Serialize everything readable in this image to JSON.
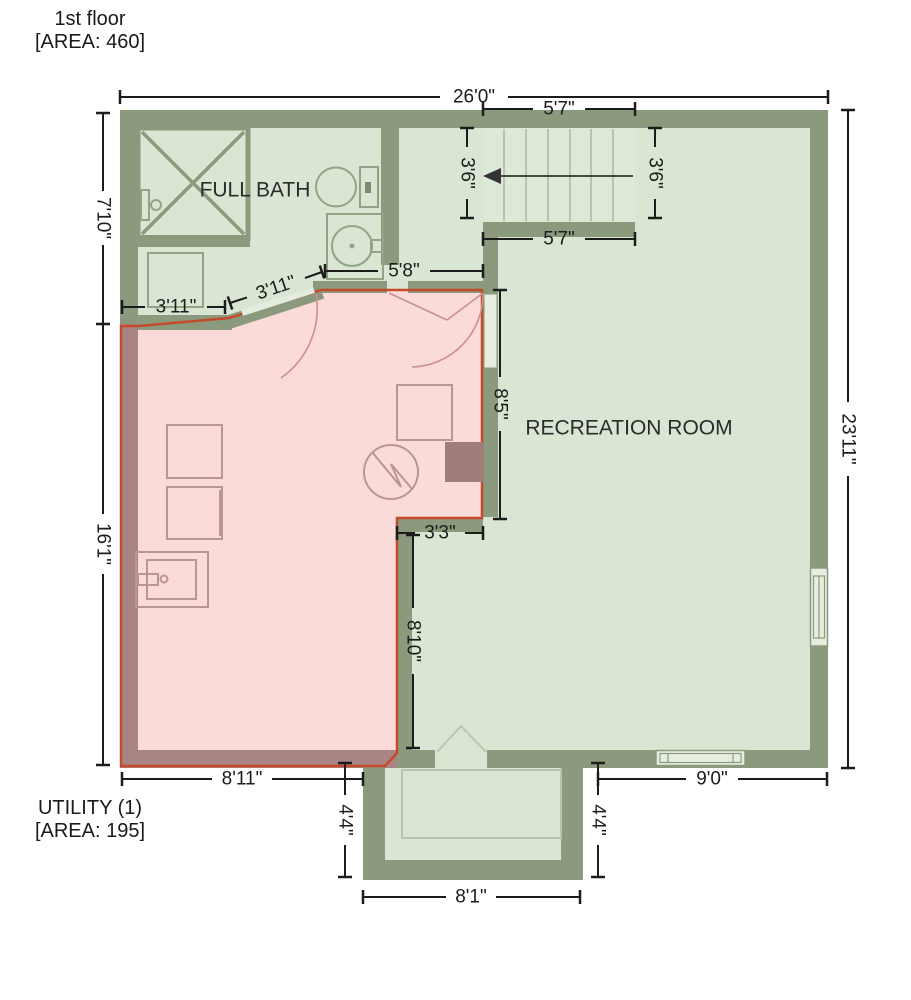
{
  "header": {
    "line1": "1st floor",
    "line2": "[AREA: 460]"
  },
  "footer": {
    "line1": "UTILITY (1)",
    "line2": "[AREA: 195]"
  },
  "rooms": {
    "full_bath": "FULL BATH",
    "recreation_room": "RECREATION ROOM"
  },
  "dimensions": {
    "top_width": "26'0\"",
    "stairs_top": "5'7\"",
    "stairs_bottom": "5'7\"",
    "stairs_left": "3'6\"",
    "stairs_right": "3'6\"",
    "left_upper": "7'10\"",
    "left_lower": "16'1\"",
    "right_full": "23'11\"",
    "bath_closet": "3'11\"",
    "bath_door": "3'11\"",
    "utility_top": "5'8\"",
    "passage": "8'5\"",
    "notch": "3'3\"",
    "utility_east": "8'10\"",
    "utility_bottom": "8'11\"",
    "porch_left": "4'4\"",
    "porch_right": "4'4\"",
    "porch_bottom": "8'1\"",
    "bottom_right": "9'0\""
  },
  "fixtures": {
    "shower": "shower-stall",
    "toilet": "toilet",
    "bath_sink": "sink",
    "cabinet": "cabinet",
    "washer": "washer",
    "dryer": "dryer",
    "laundry_sink": "laundry-sink",
    "water_heater": "water-heater",
    "stairs": "stairs-up-arrow"
  },
  "colors": {
    "wall_green": "#8b9a7d",
    "floor_green": "#d9e6d3",
    "utility_fill": "#fbdada",
    "utility_wall": "#aa8484",
    "utility_outline": "#c44a2c",
    "dimension_text": "#1c1c1c"
  }
}
